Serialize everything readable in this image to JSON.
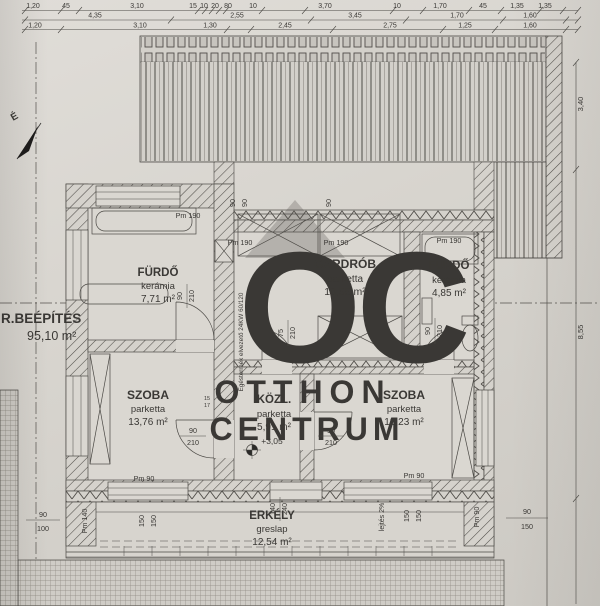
{
  "watermark": {
    "logo": "OC",
    "name_line1": "OTTHON",
    "name_line2": "CENTRUM"
  },
  "site": {
    "gross_label": "R.BEÉPÍTÉS",
    "gross_area": "95,10 m²",
    "north_letter": "É"
  },
  "rooms": {
    "bath1": {
      "name": "FÜRDŐ",
      "floor": "kerámia",
      "area": "7,71 m²"
    },
    "gardrob": {
      "name": "GARDRÓB",
      "floor": "parketta",
      "area": "10,55 m²"
    },
    "bath2": {
      "name": "FÜRDŐ",
      "floor": "kerámia",
      "area": "4,85 m²"
    },
    "room1": {
      "name": "SZOBA",
      "floor": "parketta",
      "area": "13,76 m²"
    },
    "hall": {
      "name": "KÖZL.",
      "floor": "parketta",
      "area": "5,91 m²",
      "level": "+3,05"
    },
    "room2": {
      "name": "SZOBA",
      "floor": "parketta",
      "area": "13,23 m²"
    },
    "balcony": {
      "name": "ERKÉLY",
      "floor": "greslap",
      "area": "12,54 m²",
      "slope": "lejtés 2%"
    }
  },
  "dims_top": {
    "row1": [
      "1,20",
      "45",
      "3,10",
      "15",
      "10",
      "20",
      "80",
      "10",
      "3,70",
      "10",
      "1,70",
      "45",
      "1,35",
      "1,35"
    ],
    "row2": [
      "4,35",
      "2,55",
      "3,45",
      "1,70",
      "1,60"
    ],
    "row3": [
      "1,20",
      "3,10",
      "1,30",
      "2,45",
      "2,75",
      "1,25",
      "1,60"
    ]
  },
  "dims_right": {
    "upper": "3,40",
    "lower": "8,55"
  },
  "ann": {
    "pm190": "Pm 190",
    "pm140": "Pm 140",
    "pm90": "Pm 90",
    "d90": "90",
    "d100": "100",
    "d150": "150",
    "d210": "210",
    "d75": "75",
    "d140": "140",
    "d240": "240",
    "d15": "15",
    "d17": "17",
    "flue": "Égéstermék elvezető 24KW 60/120"
  }
}
